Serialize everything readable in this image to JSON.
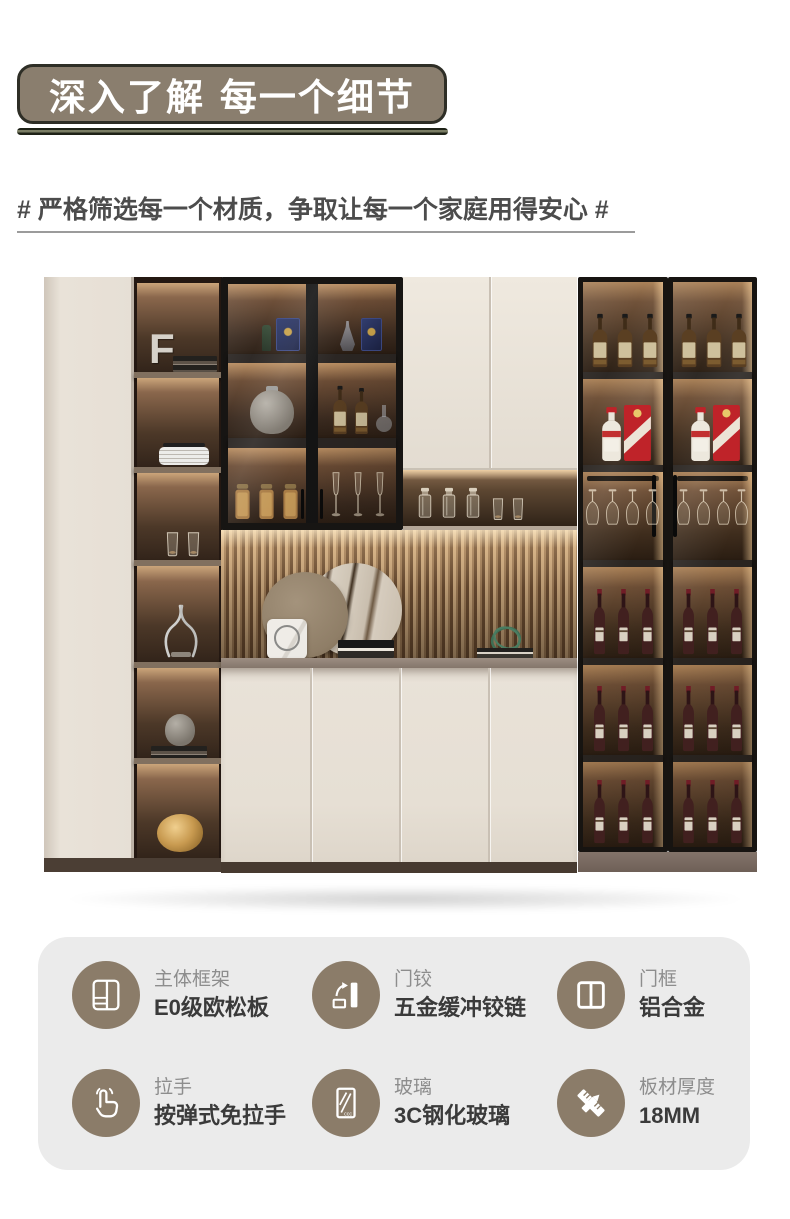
{
  "header": {
    "title": "深入了解 每一个细节"
  },
  "subtitle": {
    "text": "# 严格筛选每一个材质，争取让每一个家庭用得安心 #"
  },
  "photo": {
    "bookend_letter": "F"
  },
  "features": {
    "glass_mark": "ccc",
    "colors": {
      "card_bg": "#ebebeb",
      "icon_circle": "#8b7c69",
      "label": "#8d8d8d",
      "value": "#3a3a3a"
    },
    "items": [
      {
        "icon": "cabinet-frame-icon",
        "label": "主体框架",
        "value": "E0级欧松板"
      },
      {
        "icon": "door-hinge-icon",
        "label": "门铰",
        "value": "五金缓冲铰链"
      },
      {
        "icon": "door-frame-icon",
        "label": "门框",
        "value": "铝合金"
      },
      {
        "icon": "press-handle-icon",
        "label": "拉手",
        "value": "按弹式免拉手"
      },
      {
        "icon": "tempered-glass-icon",
        "label": "玻璃",
        "value": "3C钢化玻璃"
      },
      {
        "icon": "board-thickness-icon",
        "label": "板材厚度",
        "value": "18MM"
      }
    ]
  },
  "theme": {
    "badge_bg": "#8a7e6e",
    "badge_border": "#2e2e26",
    "title_color": "#ffffff",
    "subtitle_color": "#4c4c4c"
  }
}
